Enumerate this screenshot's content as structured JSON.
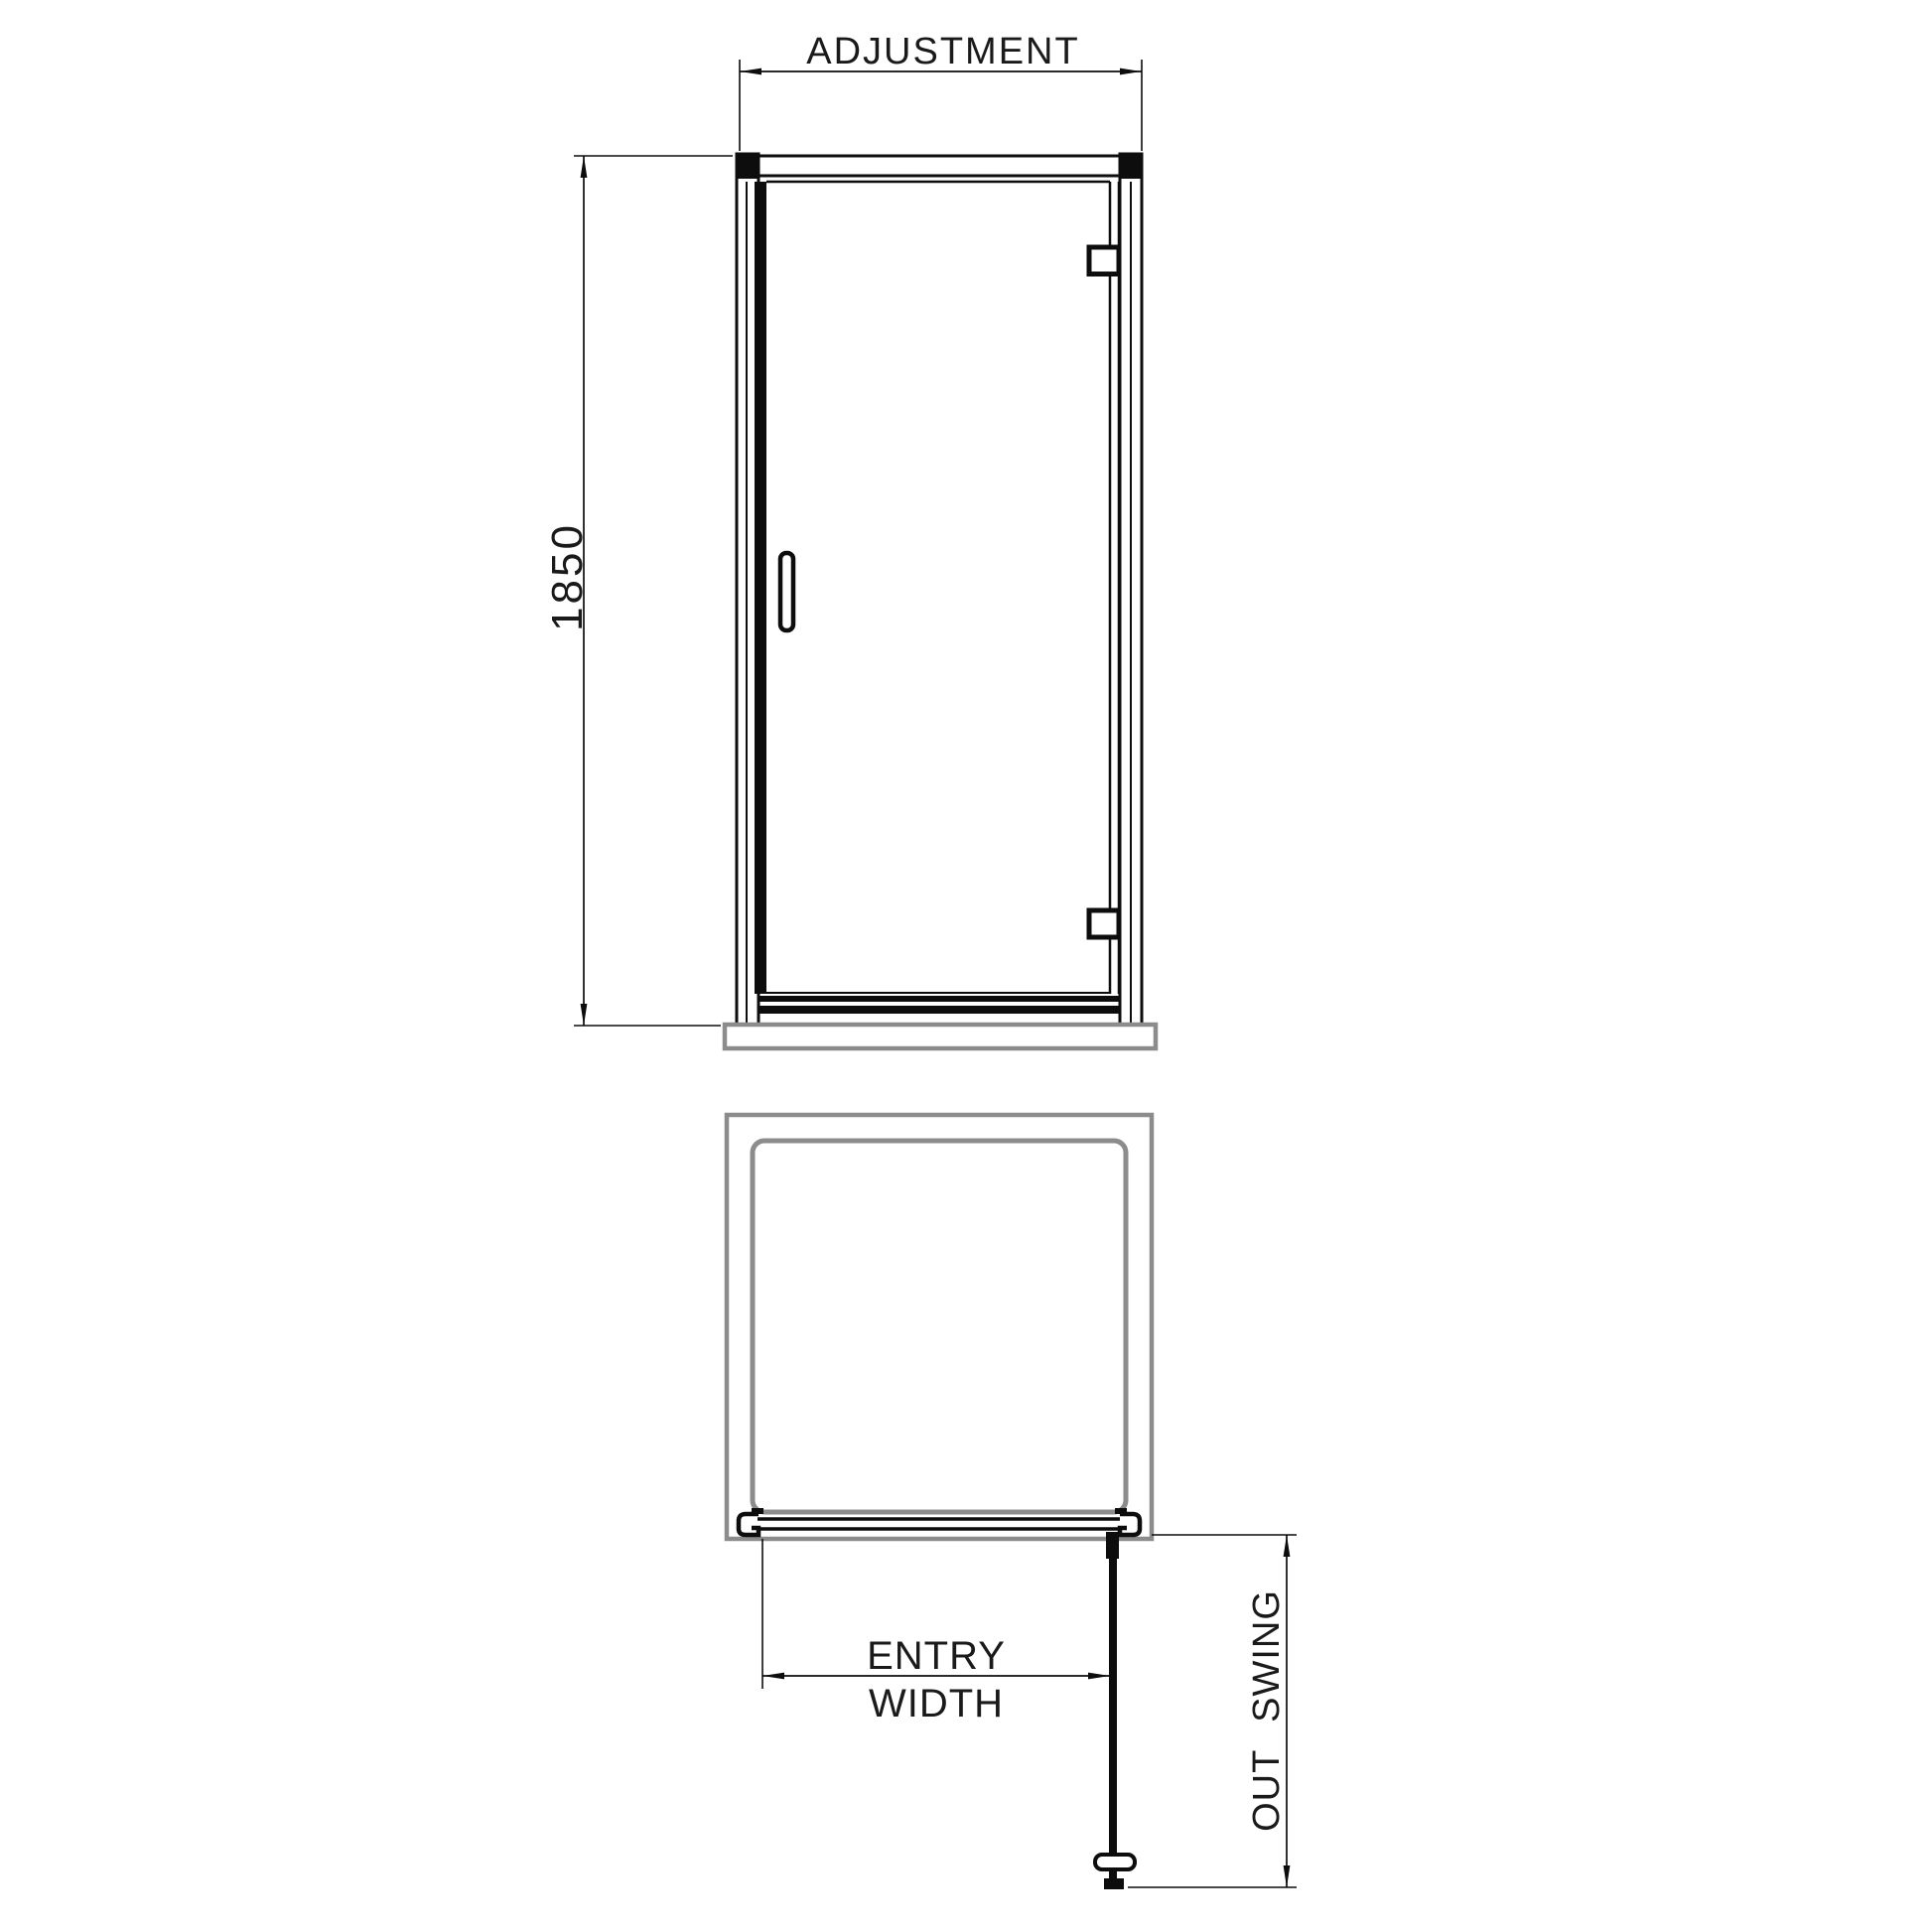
{
  "labels": {
    "adjustment": "ADJUSTMENT",
    "height": "1850",
    "entry_line1": "ENTRY",
    "entry_line2": "WIDTH",
    "out_swing": "OUT SWING"
  },
  "colors": {
    "line": "#0d0d0d",
    "text": "#1a1a1a",
    "tray_outline": "#8c8c8c",
    "background": "#ffffff"
  }
}
